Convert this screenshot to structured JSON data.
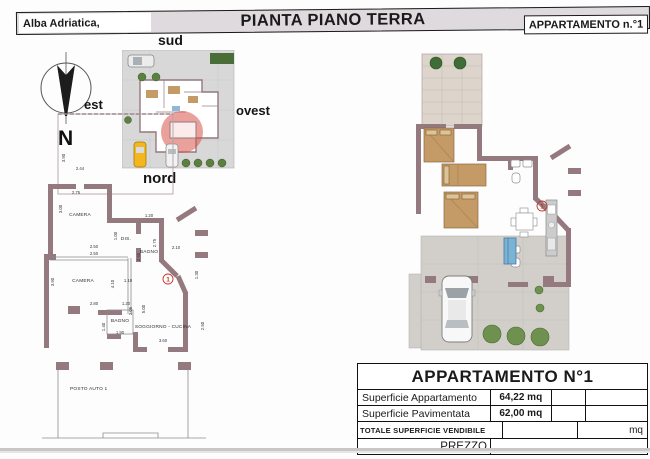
{
  "header": {
    "location": "Alba Adriatica,",
    "title": "PIANTA PIANO TERRA",
    "apartment": "APPARTAMENTO n.°1"
  },
  "compass": {
    "north_label": "N"
  },
  "site_plan": {
    "label_top": "sud",
    "label_left": "est",
    "label_right": "ovest",
    "label_bottom": "nord"
  },
  "floor_plan": {
    "rooms": {
      "camera1": "CAMERA",
      "dis": "DIS.",
      "bagno1": "BAGNO",
      "camera2": "CAMERA",
      "bagno2": "BAGNO",
      "soggiorno": "SOGGIORNO - CUCINA",
      "posto_auto": "POSTO AUTO 1",
      "unit_number": "1"
    },
    "measurements": {
      "terrace_h": "3.90",
      "terrace_w": "2.44",
      "camera1_w": "2.75",
      "camera1_h": "3.00",
      "bagno1_top": "1.20",
      "dis_h": "1.00",
      "bagno1_h": "2.75",
      "bagno1_h2": "3.60",
      "corridor_w": "2.10",
      "camera2_w1": "2.50",
      "camera2_w2": "2.50",
      "camera2_h": "3.90",
      "camera2_h2": "4.10",
      "camera2_d": "1.10",
      "entry_h": "1.30",
      "bagno2_top": "2.80",
      "bagno2_w": "1.20",
      "bagno2_h": "2.05",
      "sogg_h": "5.00",
      "bagno2_d": "1.40",
      "bagno2_b": "1.90",
      "sogg_w": "3.60",
      "sogg_h2": "2.50"
    }
  },
  "summary_table": {
    "title": "APPARTAMENTO N°1",
    "rows": [
      {
        "label": "Superficie  Appartamento",
        "value": "64,22 mq"
      },
      {
        "label": "Superficie  Pavimentata",
        "value": "62,00 mq"
      }
    ],
    "total_label": "TOTALE  SUPERFICIE  VENDIBILE",
    "total_unit": "mq",
    "price_label": "PREZZO"
  },
  "colors": {
    "wall": "#94797e",
    "highlight": "#d95348",
    "bed_tan": "#c49a66",
    "sofa_blue": "#7ab3d4",
    "car_yellow": "#f3b61f",
    "tree_green": "#5c8040"
  }
}
